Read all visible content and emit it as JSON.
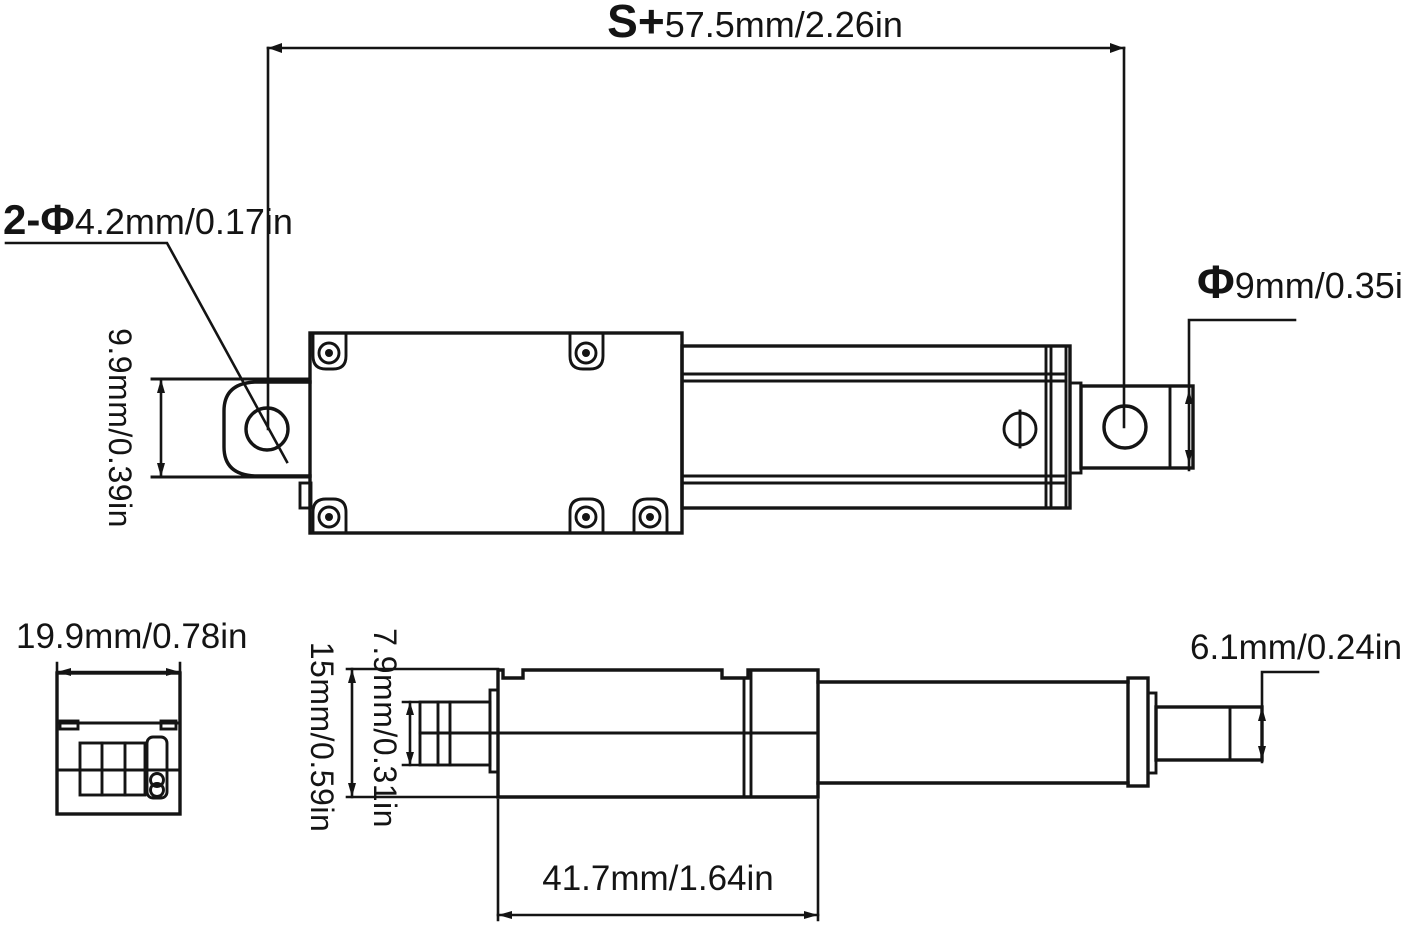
{
  "drawing_title": "micro linear actuator dimension drawing",
  "colors": {
    "background": "#ffffff",
    "line": "#141414"
  },
  "dimensions": {
    "stroke_length": {
      "prefix": "S+",
      "value": "57.5mm/2.26in"
    },
    "mounting_holes": {
      "prefix": "2-Φ",
      "value": "4.2mm/0.17in"
    },
    "rod_end_diameter": {
      "prefix": "Φ",
      "value": "9mm/0.35in"
    },
    "clevis_height": {
      "value": "9.9mm/0.39in"
    },
    "body_width": {
      "value": "19.9mm/0.78in"
    },
    "body_height": {
      "value": "15mm/0.59in"
    },
    "motor_height": {
      "value": "7.9mm/0.31in"
    },
    "gearbox_length": {
      "value": "41.7mm/1.64in"
    },
    "rod_diameter": {
      "value": "6.1mm/0.24in"
    }
  }
}
